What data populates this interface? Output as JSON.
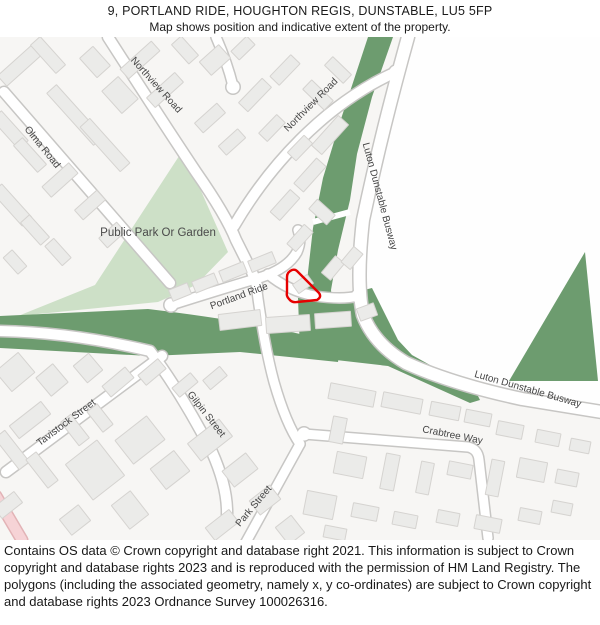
{
  "title": {
    "line1": "9, PORTLAND RIDE, HOUGHTON REGIS, DUNSTABLE, LU5 5FP",
    "line2": "Map shows position and indicative extent of the property."
  },
  "footer": {
    "text": "Contains OS data © Crown copyright and database right 2021. This information is subject to Crown copyright and database rights 2023 and is reproduced with the permission of HM Land Registry. The polygons (including the associated geometry, namely x, y co-ordinates) are subject to Crown copyright and database rights 2023 Ordnance Survey 100026316."
  },
  "map": {
    "colors": {
      "bg": "#f7f6f4",
      "white_area": "#fefefe",
      "park_green": "#cde0c7",
      "busway_green": "#6d9c6f",
      "road_casing": "#c7c6c4",
      "road_fill": "#ffffff",
      "building_fill": "#ebebe9",
      "building_stroke": "#d5d3d0",
      "label": "#454545",
      "park_label": "#4a4a4a",
      "property_red": "#e60000",
      "pink_road_fill": "#f6d3d6",
      "pink_road_casing": "#e2b3b6"
    },
    "white_area_path": "M402,0 L600,0 L600,371 L522,362 Q452,347 406,326 Q375,307 364,278 Q357,245 362,183 Q372,103 393,43 Q398,23 402,0 Z",
    "park_path": "M183,113 L228,215 L196,248 L158,265 L18,279 L95,248 Z",
    "green_paths": [
      "M368,0 L393,0 L372,60 L357,117 L350,163 L338,213 L331,253 L334,281 L352,309 L300,309 L305,273 L308,235 L313,191 L323,141 L340,85 Z",
      "M0,279 L148,272 Q240,283 300,297 L340,311 L338,325 L240,315 L150,319 L0,311 Z",
      "M298,261 L352,256 L372,251 L398,303 L412,318 L475,353 L480,363 L470,366 L388,329 L336,323 L300,315 Z",
      "M585,215 L598,344 L509,344 Z"
    ],
    "notch_line": {
      "d": "M313,185 L350,175",
      "w": 6
    },
    "roads": [
      {
        "id": "olma-road",
        "d": "M4,55 L170,246",
        "w": 10
      },
      {
        "id": "northview-road-w",
        "d": "M108,0 Q160,81 196,135 Q226,178 236,203 L252,235 L258,251",
        "w": 10
      },
      {
        "id": "northview-road-e",
        "d": "M396,35 Q345,58 300,103 Q262,141 234,189",
        "w": 10
      },
      {
        "id": "road-stub-top",
        "d": "M216,0 Q227,25 233,49",
        "w": 9
      },
      {
        "id": "busway-road",
        "d": "M408,0 Q382,93 363,183 Q356,245 363,278 Q374,307 406,326 Q452,347 522,362 L602,375",
        "w": 12
      },
      {
        "id": "portland-main",
        "d": "M171,268 Q225,251 262,240 Q288,231 297,215 Q302,204 298,193",
        "w": 9
      },
      {
        "id": "portland-branch",
        "d": "M268,237 Q288,254 315,259 Q342,263 358,259",
        "w": 9
      },
      {
        "id": "gilpin-street",
        "d": "M-2,294 Q70,295 150,314 Q182,357 212,415 Q228,451 227,479",
        "w": 10
      },
      {
        "id": "road-crossing",
        "d": "M256,247 Q264,308 274,345 Q286,387 300,407",
        "w": 9
      },
      {
        "id": "park-street",
        "d": "M300,407 L224,545",
        "w": 9
      },
      {
        "id": "tavistock-street",
        "d": "M6,435 L162,319",
        "w": 10
      },
      {
        "id": "crabtree-way",
        "d": "M304,397 L468,410 Q478,412 479,423 L488,501",
        "w": 9
      }
    ],
    "pink_road": {
      "d": "M-4,459 L22,503",
      "w": 10
    },
    "bulbs": [
      [
        171,
        268
      ],
      [
        358,
        259
      ],
      [
        233,
        50
      ],
      [
        304,
        397
      ],
      [
        396,
        35
      ]
    ],
    "buildings": [
      [
        20,
        28,
        14,
        48,
        48
      ],
      [
        48,
        18,
        38,
        13,
        48
      ],
      [
        10,
        93,
        40,
        13,
        48
      ],
      [
        30,
        118,
        36,
        12,
        48
      ],
      [
        12,
        168,
        45,
        13,
        48
      ],
      [
        35,
        193,
        30,
        12,
        48
      ],
      [
        58,
        215,
        26,
        12,
        48
      ],
      [
        15,
        225,
        22,
        12,
        48
      ],
      [
        75,
        78,
        70,
        13,
        48
      ],
      [
        105,
        108,
        60,
        13,
        48
      ],
      [
        60,
        143,
        14,
        36,
        48
      ],
      [
        90,
        168,
        13,
        30,
        48
      ],
      [
        112,
        198,
        13,
        24,
        48
      ],
      [
        140,
        23,
        13,
        42,
        48
      ],
      [
        165,
        53,
        13,
        38,
        48
      ],
      [
        120,
        58,
        30,
        22,
        48
      ],
      [
        95,
        25,
        26,
        18,
        48
      ],
      [
        185,
        13,
        26,
        13,
        48
      ],
      [
        215,
        23,
        18,
        26,
        48
      ],
      [
        243,
        11,
        22,
        12,
        -44
      ],
      [
        210,
        81,
        13,
        30,
        48
      ],
      [
        232,
        105,
        12,
        26,
        48
      ],
      [
        255,
        58,
        34,
        13,
        -46
      ],
      [
        285,
        33,
        30,
        13,
        -46
      ],
      [
        272,
        91,
        26,
        12,
        -46
      ],
      [
        300,
        111,
        24,
        12,
        -46
      ],
      [
        318,
        58,
        13,
        30,
        -46
      ],
      [
        338,
        33,
        12,
        26,
        -46
      ],
      [
        330,
        98,
        40,
        14,
        -48
      ],
      [
        310,
        138,
        34,
        13,
        -48
      ],
      [
        285,
        168,
        30,
        13,
        -48
      ],
      [
        322,
        175,
        13,
        24,
        -48
      ],
      [
        300,
        201,
        26,
        12,
        -48
      ],
      [
        262,
        225,
        26,
        12,
        -22
      ],
      [
        233,
        235,
        26,
        12,
        -22
      ],
      [
        205,
        246,
        24,
        12,
        -22
      ],
      [
        180,
        255,
        20,
        12,
        -22
      ],
      [
        303,
        247,
        18,
        11,
        -35
      ],
      [
        333,
        231,
        22,
        12,
        -50
      ],
      [
        352,
        221,
        20,
        12,
        -50
      ],
      [
        240,
        283,
        42,
        16,
        -7
      ],
      [
        288,
        287,
        44,
        16,
        -4
      ],
      [
        333,
        283,
        36,
        15,
        -4
      ],
      [
        367,
        275,
        18,
        13,
        -20
      ],
      [
        15,
        335,
        30,
        26,
        -40
      ],
      [
        52,
        343,
        22,
        24,
        -40
      ],
      [
        88,
        331,
        20,
        22,
        -40
      ],
      [
        118,
        345,
        30,
        14,
        -40
      ],
      [
        152,
        335,
        26,
        13,
        -40
      ],
      [
        185,
        348,
        24,
        12,
        -40
      ],
      [
        215,
        341,
        22,
        12,
        -40
      ],
      [
        30,
        383,
        40,
        16,
        -38
      ],
      [
        12,
        413,
        13,
        40,
        -38
      ],
      [
        42,
        433,
        13,
        36,
        -38
      ],
      [
        8,
        468,
        26,
        14,
        -38
      ],
      [
        75,
        393,
        13,
        30,
        -38
      ],
      [
        100,
        381,
        13,
        26,
        -38
      ],
      [
        95,
        433,
        40,
        45,
        -38
      ],
      [
        140,
        403,
        30,
        40,
        52
      ],
      [
        170,
        433,
        26,
        30,
        52
      ],
      [
        130,
        473,
        30,
        24,
        52
      ],
      [
        75,
        483,
        24,
        20,
        -38
      ],
      [
        210,
        403,
        22,
        40,
        52
      ],
      [
        240,
        433,
        20,
        30,
        52
      ],
      [
        265,
        463,
        18,
        26,
        52
      ],
      [
        222,
        488,
        30,
        16,
        -38
      ],
      [
        290,
        493,
        22,
        20,
        52
      ],
      [
        352,
        358,
        46,
        16,
        11
      ],
      [
        402,
        366,
        40,
        15,
        11
      ],
      [
        445,
        374,
        30,
        14,
        11
      ],
      [
        478,
        381,
        26,
        13,
        11
      ],
      [
        338,
        393,
        14,
        26,
        11
      ],
      [
        510,
        393,
        26,
        14,
        11
      ],
      [
        548,
        401,
        24,
        13,
        11
      ],
      [
        580,
        409,
        20,
        12,
        11
      ],
      [
        350,
        428,
        30,
        22,
        11
      ],
      [
        390,
        435,
        14,
        36,
        11
      ],
      [
        425,
        441,
        13,
        32,
        11
      ],
      [
        460,
        433,
        24,
        14,
        11
      ],
      [
        495,
        441,
        13,
        36,
        11
      ],
      [
        532,
        433,
        28,
        20,
        11
      ],
      [
        567,
        441,
        22,
        14,
        11
      ],
      [
        320,
        468,
        30,
        24,
        11
      ],
      [
        365,
        475,
        26,
        14,
        11
      ],
      [
        405,
        483,
        24,
        13,
        11
      ],
      [
        448,
        481,
        22,
        13,
        11
      ],
      [
        488,
        487,
        26,
        14,
        11
      ],
      [
        530,
        479,
        22,
        13,
        11
      ],
      [
        562,
        471,
        20,
        12,
        11
      ],
      [
        335,
        496,
        22,
        12,
        11
      ]
    ],
    "property_path": "M297,234 L319,256 Q322,260 317,263 L297,265 Q292,266 289,262 Q286,259 287,255 L287,240 Q287,235 292,233 Q295,232 297,234 Z",
    "labels": [
      {
        "id": "label-olma-road",
        "text": "Olma Road",
        "x": 40,
        "y": 112,
        "rotate": 51,
        "size": 10
      },
      {
        "id": "label-northview-road-w",
        "text": "Northview Road",
        "x": 154,
        "y": 50,
        "rotate": 48,
        "size": 10
      },
      {
        "id": "label-northview-road-e",
        "text": "Northview Road",
        "x": 313,
        "y": 70,
        "rotate": -45,
        "size": 10
      },
      {
        "id": "label-public-park",
        "text": "Public Park Or Garden",
        "x": 158,
        "y": 199,
        "rotate": 0,
        "size": 11.5
      },
      {
        "id": "label-portland-ride",
        "text": "Portland Ride",
        "x": 240,
        "y": 262,
        "rotate": -20,
        "size": 10
      },
      {
        "id": "label-busway-north",
        "text": "Luton Dunstable Busway",
        "x": 377,
        "y": 160,
        "rotate": 75,
        "size": 10
      },
      {
        "id": "label-busway-south",
        "text": "Luton Dunstable Busway",
        "x": 527,
        "y": 355,
        "rotate": 16,
        "size": 10
      },
      {
        "id": "label-tavistock-street",
        "text": "Tavistock Street",
        "x": 68,
        "y": 388,
        "rotate": -37,
        "size": 10
      },
      {
        "id": "label-gilpin-street",
        "text": "Gilpin Street",
        "x": 204,
        "y": 379,
        "rotate": 52,
        "size": 10
      },
      {
        "id": "label-park-street",
        "text": "Park Street",
        "x": 256,
        "y": 471,
        "rotate": -50,
        "size": 10
      },
      {
        "id": "label-crabtree-way",
        "text": "Crabtree Way",
        "x": 452,
        "y": 401,
        "rotate": 11,
        "size": 10
      }
    ]
  }
}
